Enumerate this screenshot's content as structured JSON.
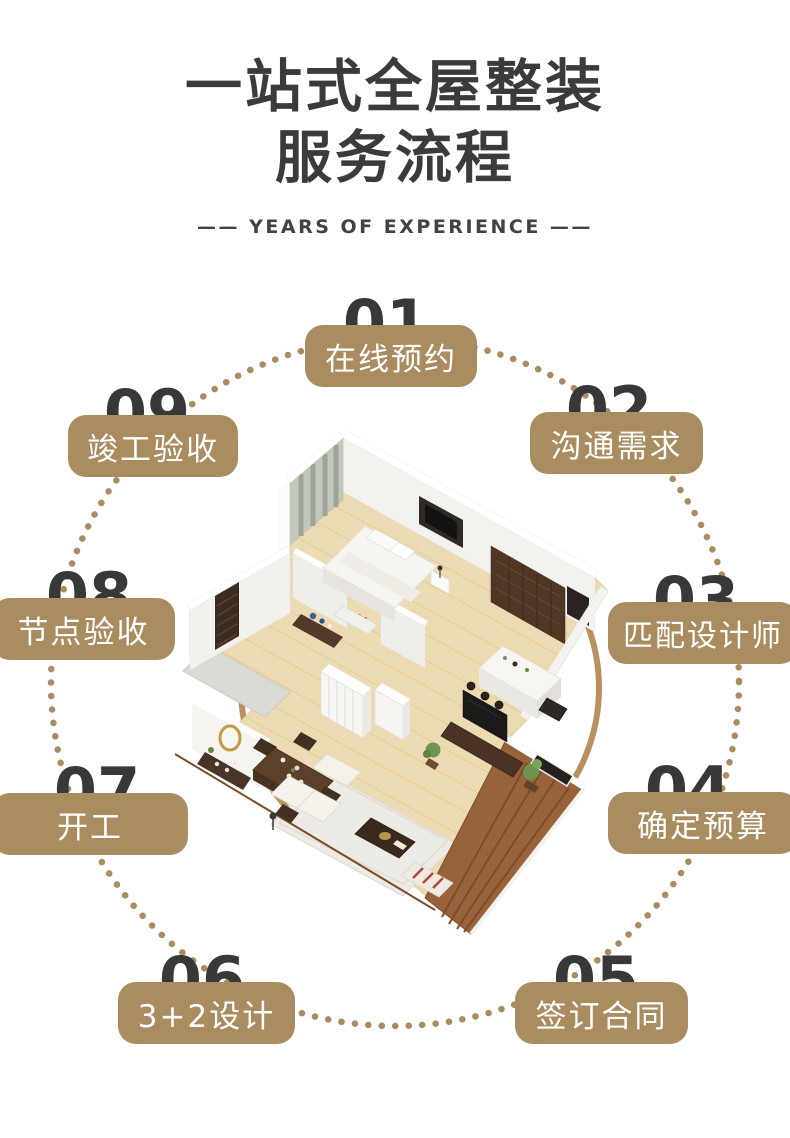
{
  "header": {
    "title_line1": "一站式全屋整装",
    "title_line2": "服务流程",
    "subtitle": "—— YEARS OF EXPERIENCE ——"
  },
  "steps": [
    {
      "num": "01",
      "label": "在线预约"
    },
    {
      "num": "02",
      "label": "沟通需求"
    },
    {
      "num": "03",
      "label": "匹配设计师"
    },
    {
      "num": "04",
      "label": "确定预算"
    },
    {
      "num": "05",
      "label": "签订合同"
    },
    {
      "num": "06",
      "label": "3+2设计"
    },
    {
      "num": "07",
      "label": "开工"
    },
    {
      "num": "08",
      "label": "节点验收"
    },
    {
      "num": "09",
      "label": "竣工验收"
    }
  ],
  "illustration": {
    "name": "isometric-floor-plan-render"
  },
  "colors": {
    "accent_tan": "#a98c60",
    "ring_tan": "#b9905e",
    "number_dark": "#383838",
    "title_dark": "#3b3b3b",
    "pill_text": "#ffffff"
  }
}
